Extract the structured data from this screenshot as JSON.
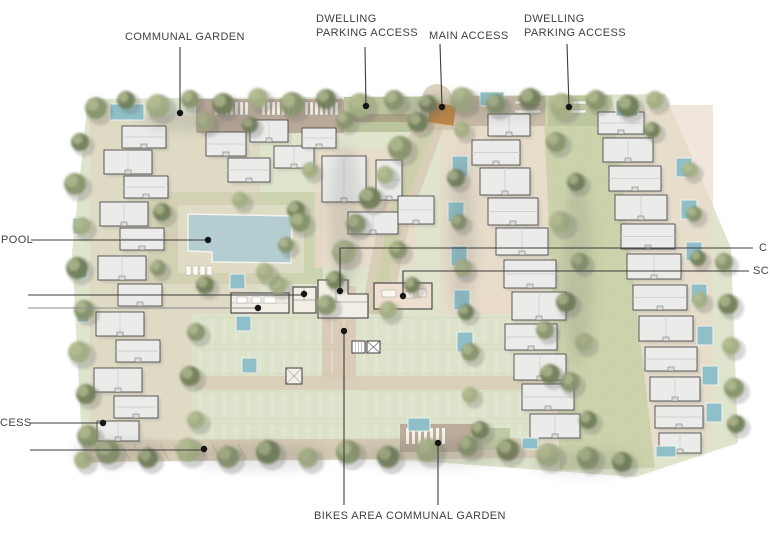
{
  "labels": {
    "communal_garden_top": "COMMUNAL GARDEN",
    "dwelling_parking_1_line1": "DWELLING",
    "dwelling_parking_1_line2": "PARKING ACCESS",
    "main_access": "MAIN ACCESS",
    "dwelling_parking_2_line1": "DWELLING",
    "dwelling_parking_2_line2": "PARKING ACCESS",
    "pool": "POOL",
    "access_left_cut": "CESS",
    "right_top_cut": "C",
    "right_bottom_cut": "SC",
    "bikes_area": "BIKES AREA",
    "communal_garden_bottom": "COMMUNAL GARDEN"
  },
  "colors": {
    "label_text": "#3f3f3f",
    "leader_line": "#3c3c3c",
    "leader_line_light": "#8f8f8f",
    "leader_dot": "#151515",
    "site_base": "#dfe4cd",
    "lawn": "#c9d2ae",
    "water": "#b3cdd1",
    "plunge_pool": "#8fc0ca",
    "building_fill": "#ebecea",
    "building_outline": "#4b4b4b",
    "club_fill": "#f3eee5",
    "club_pink": "#eedfd0",
    "path_tan": "#d8ccb6",
    "road_tan": "#d6c9b3",
    "parking_green": "#dde3ca",
    "checker_green": "#ccd3ab",
    "garden_mauve": "#b7a596",
    "garden_green": "#b9c29b",
    "paving_pink": "#ead9c9",
    "entrance_marker": "#bd8440",
    "tree_olive": "#86926a",
    "tree_dark": "#6f7d57",
    "tree_light": "#a3ae83",
    "tree_brown": "#908d68"
  }
}
